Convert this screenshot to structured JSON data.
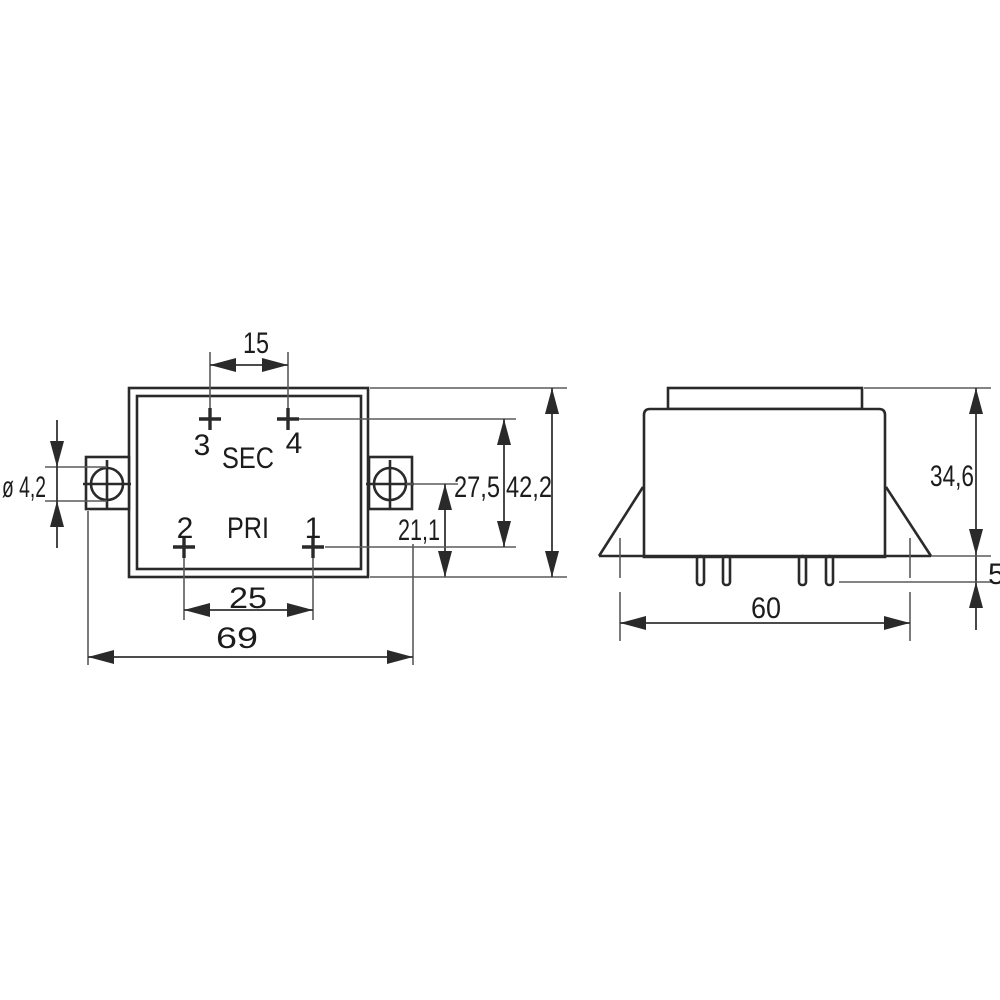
{
  "drawing": {
    "kind": "technical-dimension-drawing",
    "subject": "PCB transformer, top view and side view",
    "units_style": "millimetres with comma decimals"
  },
  "top_view": {
    "winding_labels": {
      "secondary": "SEC",
      "primary": "PRI"
    },
    "pins": {
      "pin1": "1",
      "pin2": "2",
      "pin3": "3",
      "pin4": "4"
    },
    "dimensions": {
      "sec_pin_spacing": "15",
      "pri_pin_spacing": "25",
      "overall_width": "69",
      "mount_hole_diameter": "ø 4,2",
      "pin_row_spacing": "27,5",
      "body_depth": "42,2",
      "hole_axis_to_edge": "21,1"
    }
  },
  "side_view": {
    "dimensions": {
      "overall_height": "34,6",
      "pin_length": "5",
      "mount_hole_spacing": "60"
    }
  },
  "colors": {
    "object_line": "#2a2a2a",
    "dimension_line": "#333333",
    "extension_line": "#5a5a5a",
    "text": "#1c1c1c",
    "background": "#ffffff"
  }
}
